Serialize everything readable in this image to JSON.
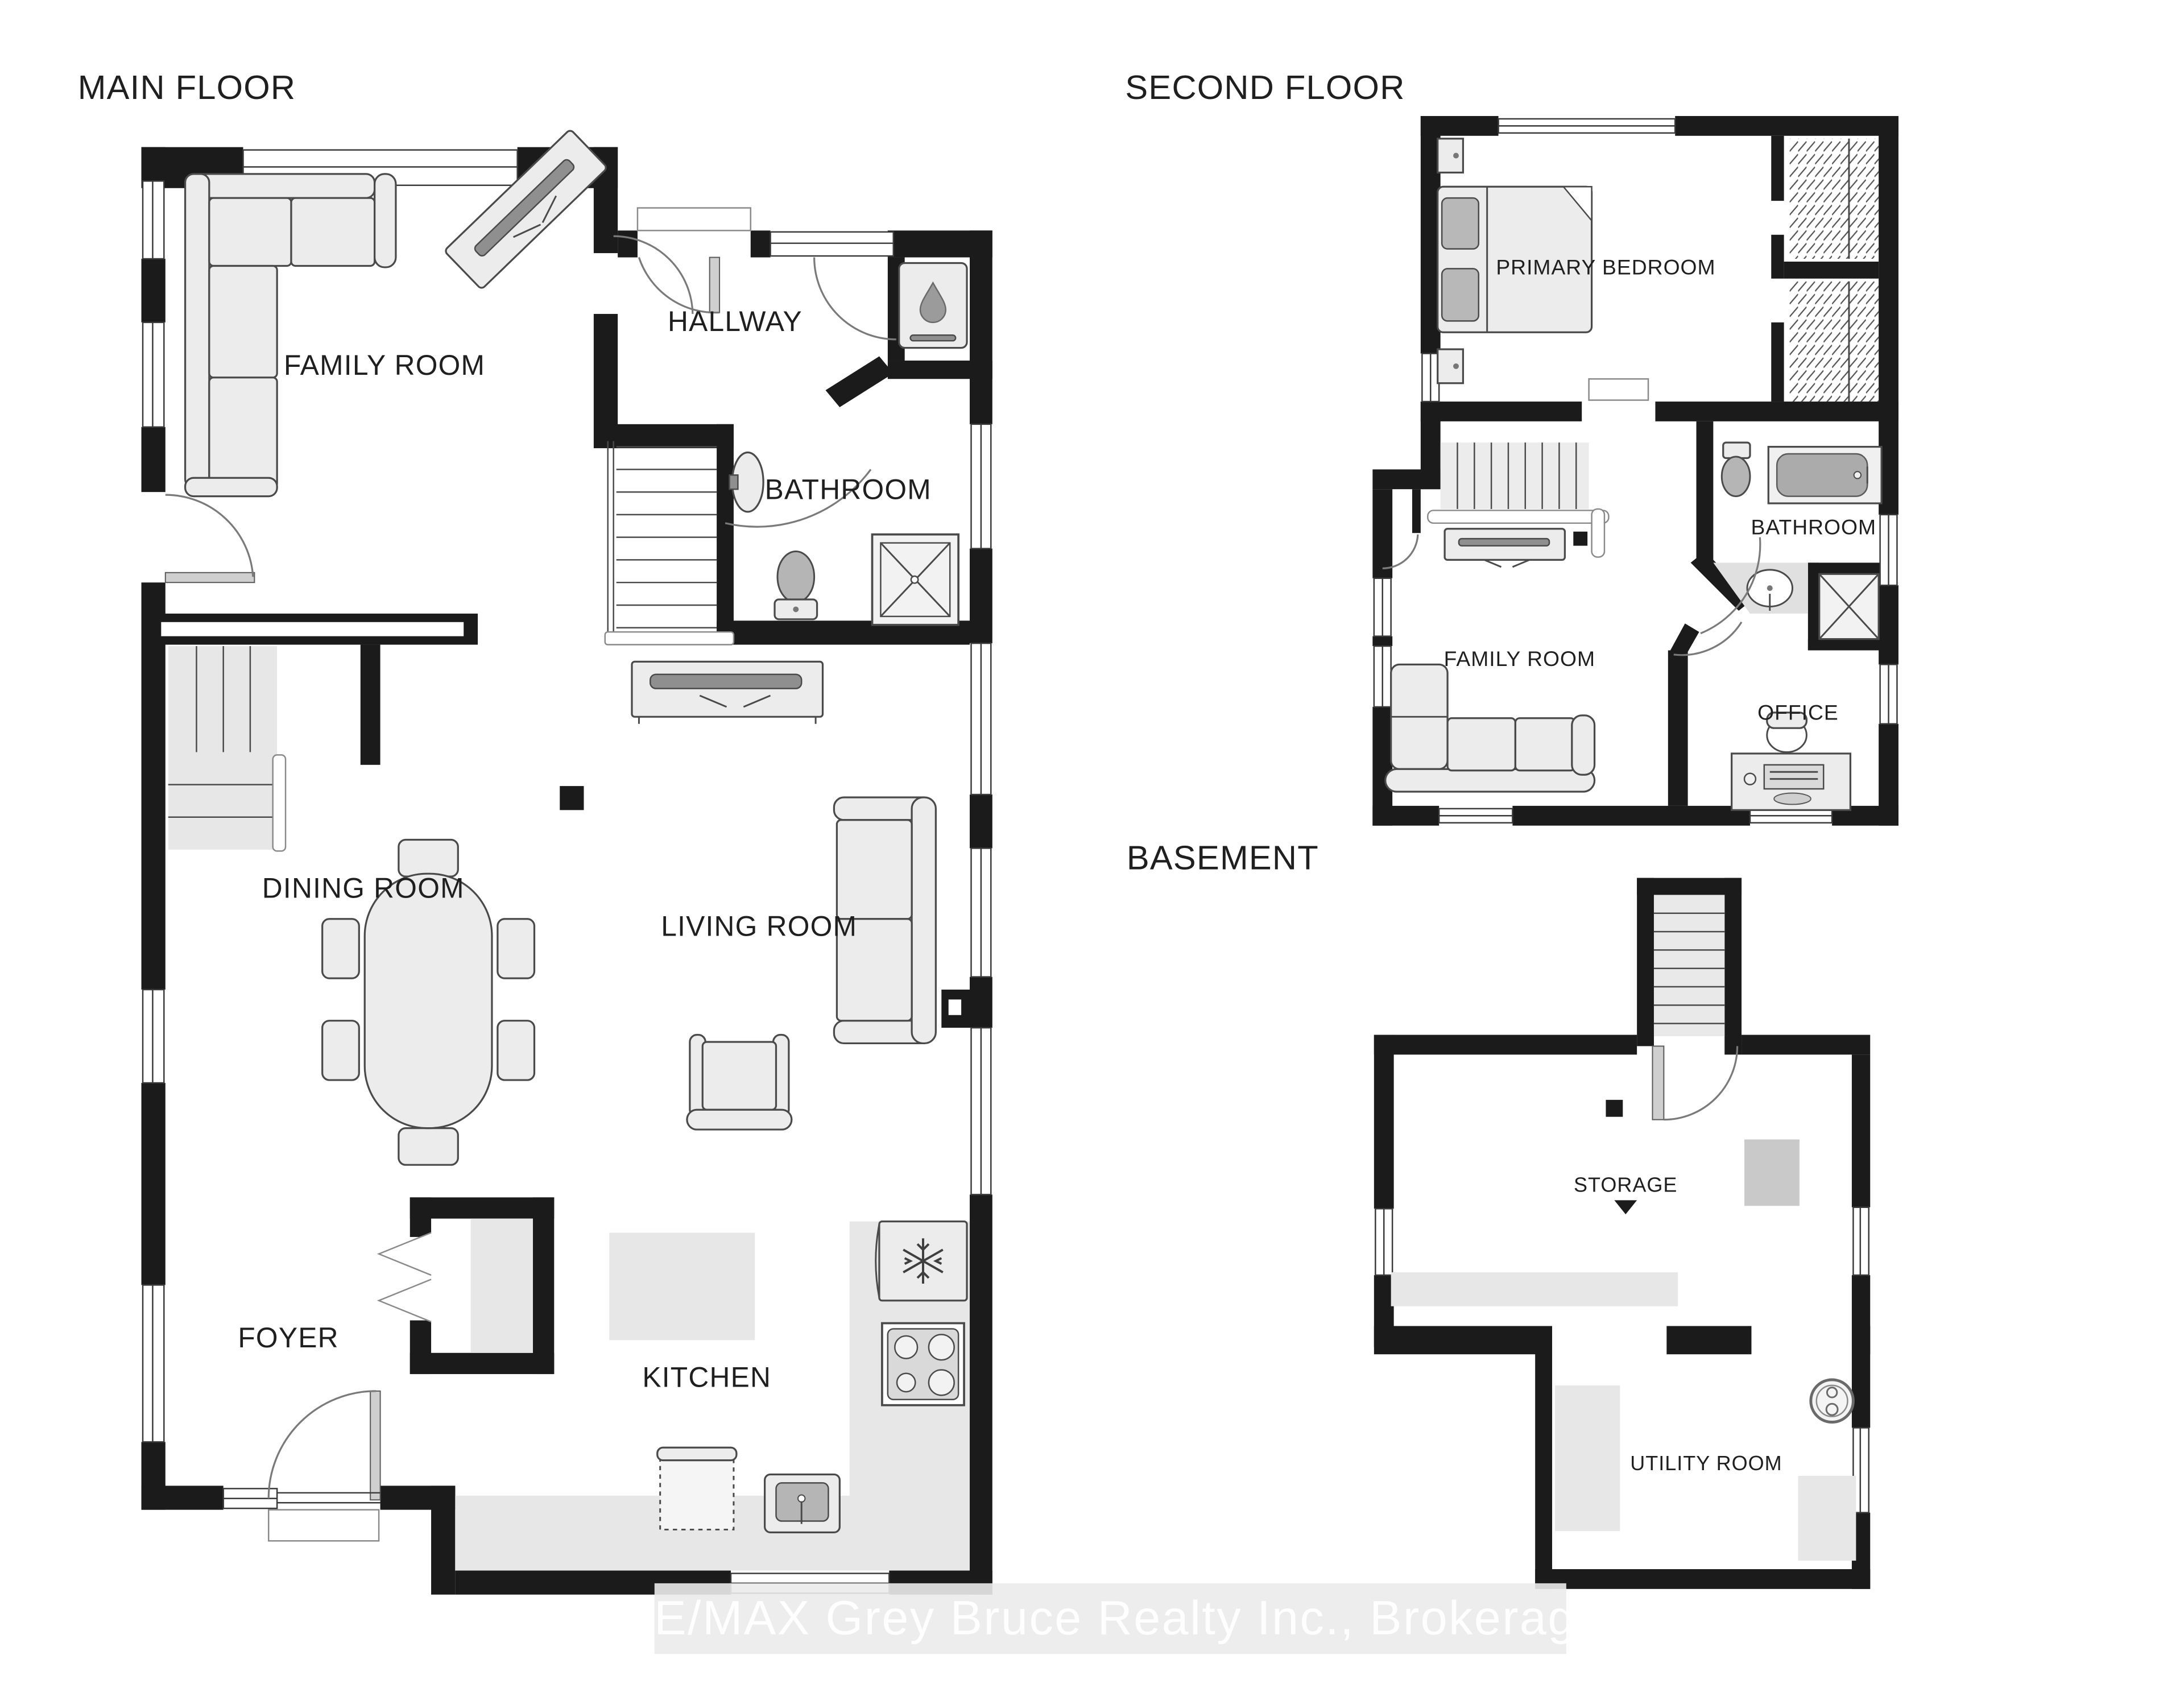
{
  "page": {
    "background": "#ffffff",
    "wall_color": "#1b1b1b",
    "furniture_fill": "#ececec",
    "counter_fill": "#e7e7e7"
  },
  "watermark": {
    "text": "RE/MAX Grey Bruce Realty Inc., Brokerage",
    "band_color": "#ebebeb",
    "text_color": "#ffffff"
  },
  "floors": {
    "main": {
      "title": "MAIN FLOOR",
      "rooms": {
        "family_room": "FAMILY ROOM",
        "hallway": "HALLWAY",
        "bathroom": "BATHROOM",
        "dining_room": "DINING ROOM",
        "living_room": "LIVING ROOM",
        "foyer": "FOYER",
        "kitchen": "KITCHEN"
      }
    },
    "second": {
      "title": "SECOND FLOOR",
      "rooms": {
        "primary_bedroom": "PRIMARY BEDROOM",
        "bathroom": "BATHROOM",
        "family_room": "FAMILY ROOM",
        "office": "OFFICE"
      }
    },
    "basement": {
      "title": "BASEMENT",
      "rooms": {
        "storage": "STORAGE",
        "utility_room": "UTILITY ROOM"
      }
    }
  },
  "icons": {
    "water_drop": "water-drop-icon",
    "snowflake": "snowflake-icon",
    "storage_arrow": "down-arrow-icon"
  }
}
